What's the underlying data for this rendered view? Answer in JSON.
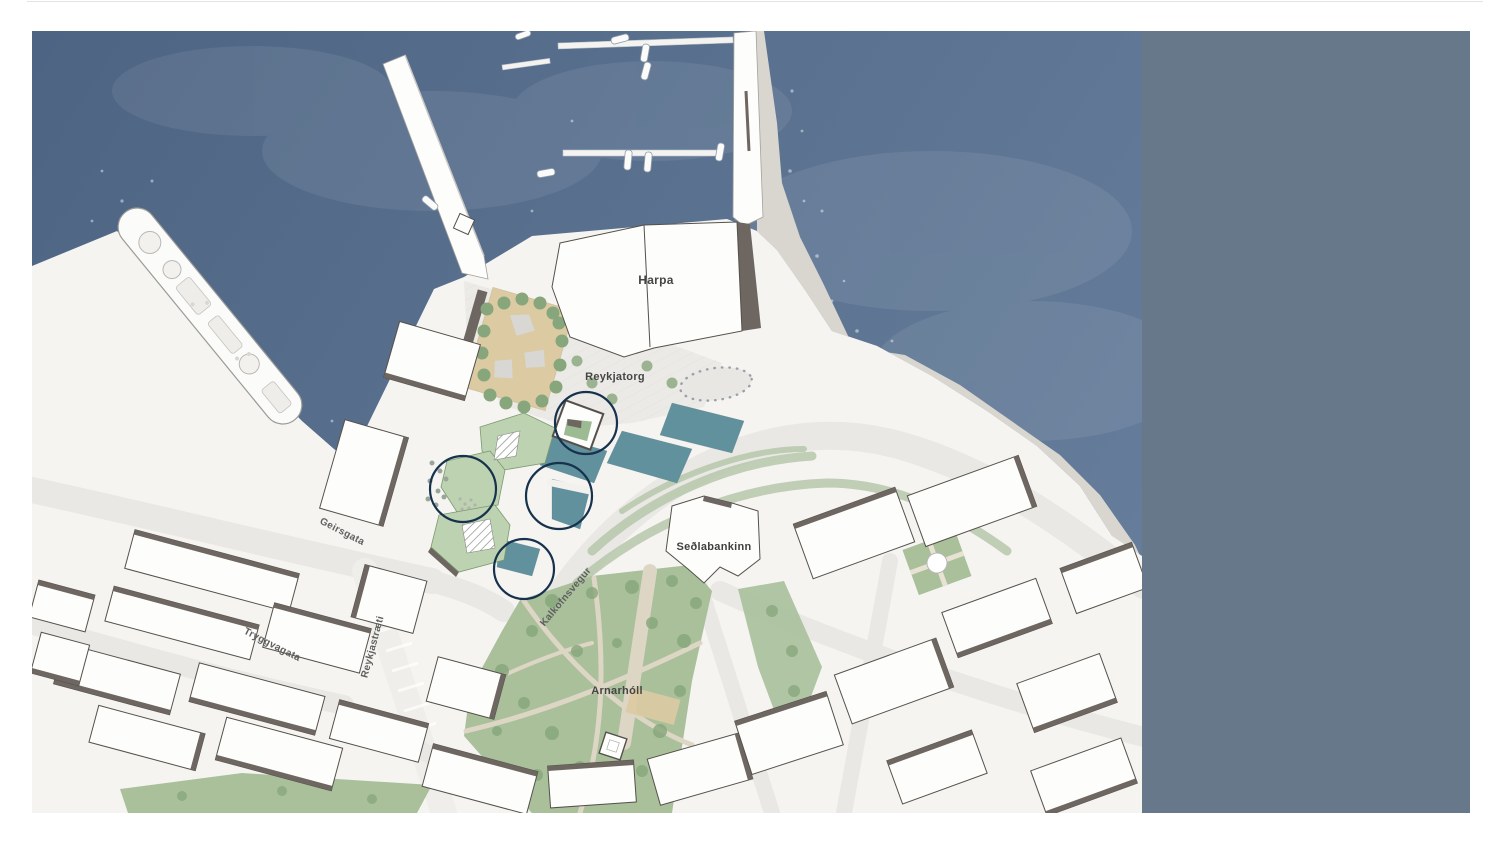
{
  "page": {
    "background": "#ffffff",
    "top_rule_color": "#e3e3e1",
    "description": "Site plan map of Reykjavik harbour around Harpa with four circled intervention sites"
  },
  "map": {
    "x": 32,
    "y": 31,
    "width": 1438,
    "height": 782,
    "colors": {
      "water_deep": "#4d6483",
      "water_light": "#68809d",
      "land": "#f5f4f1",
      "beach": "#d9d6d0",
      "road": "#e9e8e4",
      "road_light": "#efeeea",
      "building_fill": "#fdfdfb",
      "building_stroke": "#55504b",
      "shadow": "#6e6660",
      "park_green": "#a9c09b",
      "tree_green": "#87a67b",
      "roof_green": "#bdd2b0",
      "roof_stroke": "#7d9a72",
      "pool_teal": "#60919d",
      "sand": "#dccaa2",
      "plaza": "#eceae7",
      "pier_stroke": "#a3a29e",
      "park_path": "#ddd6c4",
      "median_green": "#b5c7aa",
      "panel": "#66788a",
      "annotation": "#17324d"
    },
    "labels": [
      {
        "id": "harpa",
        "text": "Harpa",
        "x": 624,
        "y": 249,
        "rotation": 0,
        "font_size": 12,
        "color": "#454545",
        "type": "building"
      },
      {
        "id": "reykjatorg",
        "text": "Reykjatorg",
        "x": 583,
        "y": 346,
        "rotation": 0,
        "font_size": 11,
        "color": "#454545",
        "type": "square"
      },
      {
        "id": "sedlabankinn",
        "text": "Seðlabankinn",
        "x": 682,
        "y": 516,
        "rotation": 0,
        "font_size": 11,
        "color": "#3f3f3f",
        "type": "building"
      },
      {
        "id": "arnarholl",
        "text": "Arnarhóll",
        "x": 585,
        "y": 660,
        "rotation": 0,
        "font_size": 11,
        "color": "#454545",
        "type": "park"
      },
      {
        "id": "geirsgata",
        "text": "Geirsgata",
        "x": 310,
        "y": 501,
        "rotation": 27,
        "font_size": 10,
        "color": "#5f5f5f",
        "type": "street"
      },
      {
        "id": "tryggvagata",
        "text": "Tryggvagata",
        "x": 240,
        "y": 614,
        "rotation": 27,
        "font_size": 10,
        "color": "#5f5f5f",
        "type": "street"
      },
      {
        "id": "reykjastraeti",
        "text": "Reykjastræti",
        "x": 341,
        "y": 616,
        "rotation": -75,
        "font_size": 10,
        "color": "#5f5f5f",
        "type": "street"
      },
      {
        "id": "kalkofnsvegur",
        "text": "Kalkofnsvegur",
        "x": 534,
        "y": 566,
        "rotation": -50,
        "font_size": 10,
        "color": "#5f5f5f",
        "type": "street"
      }
    ],
    "annotation_circles": {
      "color": "#17324d",
      "items": [
        {
          "id": "circle-north",
          "x": 554,
          "y": 392,
          "r": 31
        },
        {
          "id": "circle-west",
          "x": 431,
          "y": 458,
          "r": 33
        },
        {
          "id": "circle-middle",
          "x": 527,
          "y": 465,
          "r": 33
        },
        {
          "id": "circle-south",
          "x": 492,
          "y": 538,
          "r": 30
        }
      ]
    },
    "side_panel": {
      "x": 1110,
      "width": 328,
      "color": "#66788a"
    }
  }
}
